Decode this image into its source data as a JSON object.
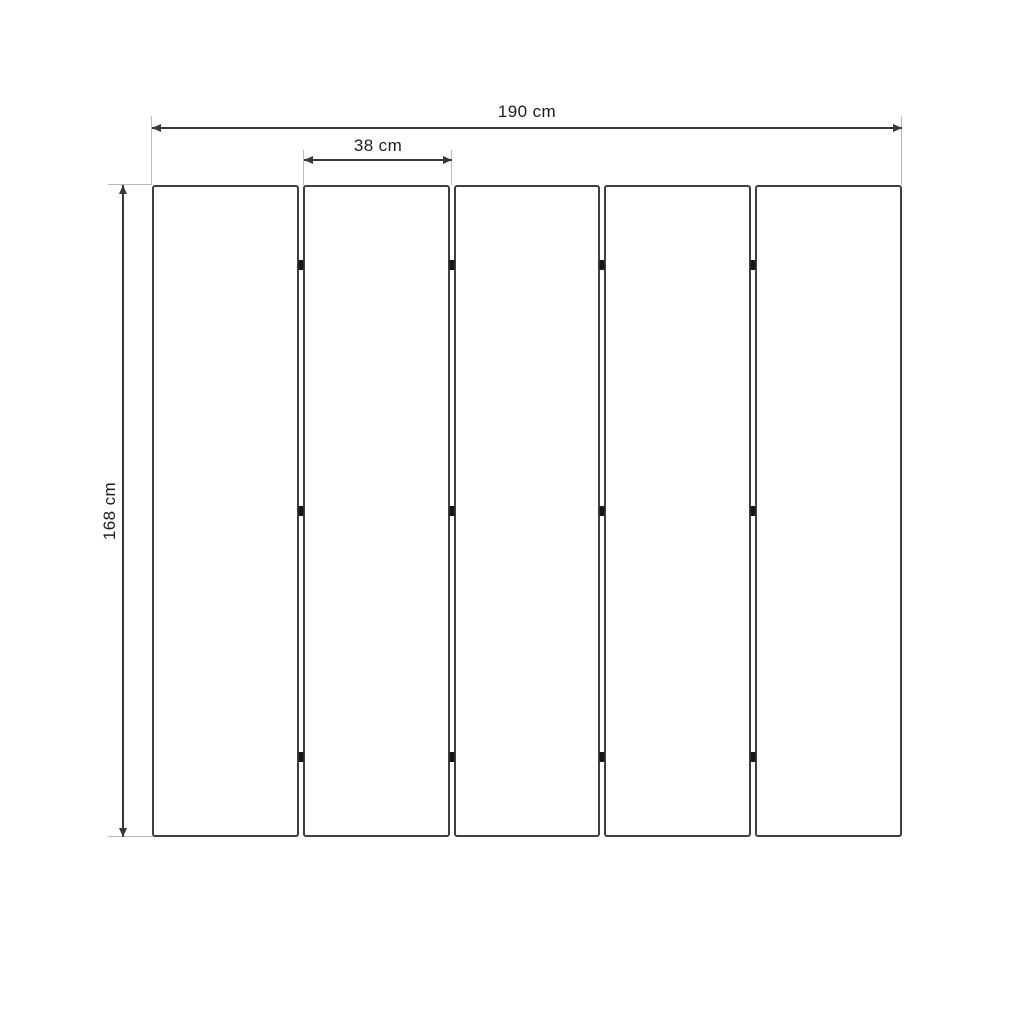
{
  "diagram": {
    "dimensions": {
      "total_width": {
        "label": "190 cm",
        "value": 190,
        "unit": "cm"
      },
      "panel_width": {
        "label": "38 cm",
        "value": 38,
        "unit": "cm"
      },
      "height": {
        "label": "168 cm",
        "value": 168,
        "unit": "cm"
      }
    },
    "panels": {
      "count": 5,
      "gaps": 4,
      "hinge_rows": 3
    },
    "colors": {
      "background": "#ffffff",
      "panel_border": "#3f3f3f",
      "dimension_line": "#383838",
      "extension_line": "#b9b9b9",
      "hinge": "#161616",
      "text": "#1d1d1d"
    }
  }
}
